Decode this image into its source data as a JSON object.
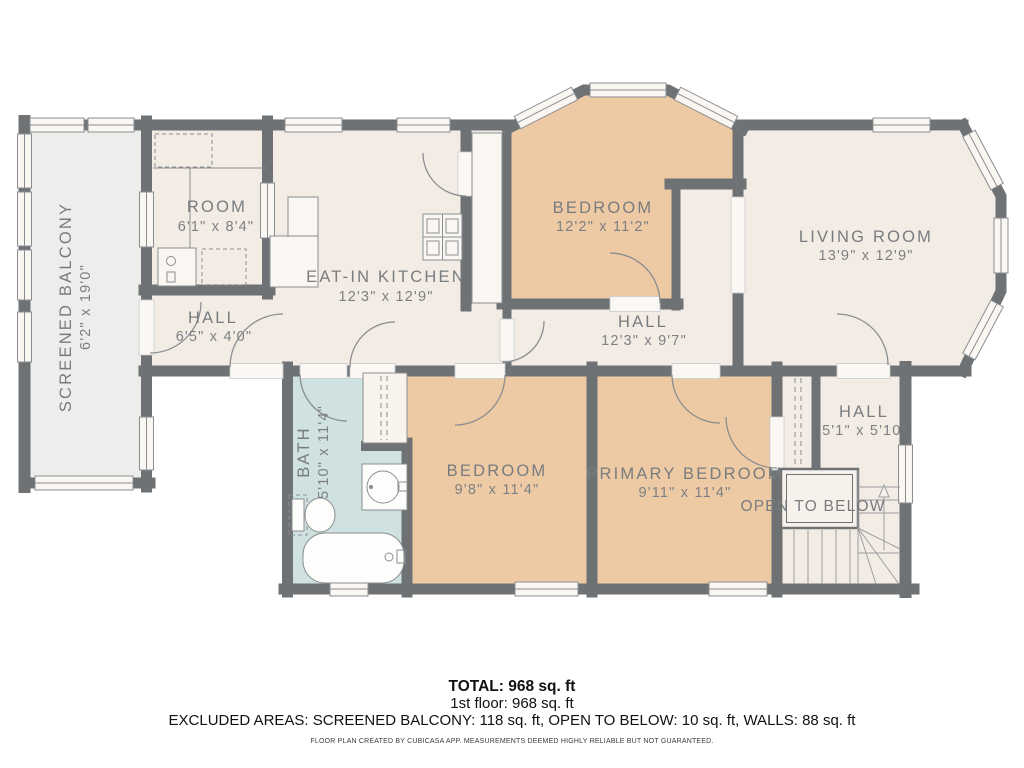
{
  "rooms": {
    "screened_balcony": {
      "name": "SCREENED BALCONY",
      "dims": "6'2\" x 19'0\""
    },
    "room": {
      "name": "ROOM",
      "dims": "6'1\" x 8'4\""
    },
    "kitchen": {
      "name": "EAT-IN KITCHEN",
      "dims": "12'3\" x 12'9\""
    },
    "hall_upper": {
      "name": "HALL",
      "dims": "6'5\" x 4'0\""
    },
    "bedroom_top": {
      "name": "BEDROOM",
      "dims": "12'2\" x 11'2\""
    },
    "living_room": {
      "name": "LIVING ROOM",
      "dims": "13'9\" x 12'9\""
    },
    "hall_mid": {
      "name": "HALL",
      "dims": "12'3\" x 9'7\""
    },
    "bath": {
      "name": "BATH",
      "dims": "5'10\" x 11'4\""
    },
    "bedroom_lower": {
      "name": "BEDROOM",
      "dims": "9'8\" x 11'4\""
    },
    "primary_bedroom": {
      "name": "PRIMARY BEDROOM",
      "dims": "9'11\" x 11'4\""
    },
    "hall_lower": {
      "name": "HALL",
      "dims": "5'1\" x 5'10\""
    },
    "open_to_below": {
      "name": "OPEN TO BELOW"
    }
  },
  "colors": {
    "wall": "#6e7275",
    "room_fill": "#f3ece5",
    "bedroom_fill": "#edcaa4",
    "bath_fill": "#cfe1e0",
    "balcony_fill": "#ededec",
    "fixture_fill": "#faf6f2",
    "line": "#8b8e91",
    "label_text": "#797c7f"
  },
  "footer": {
    "total": "TOTAL: 968 sq. ft",
    "floor": "1st floor: 968 sq. ft",
    "excluded": "EXCLUDED AREAS: SCREENED BALCONY: 118 sq. ft, OPEN TO BELOW: 10 sq. ft, WALLS: 88 sq. ft",
    "disclaimer": "FLOOR PLAN CREATED BY CUBICASA APP. MEASUREMENTS DEEMED HIGHLY RELIABLE BUT NOT GUARANTEED."
  }
}
